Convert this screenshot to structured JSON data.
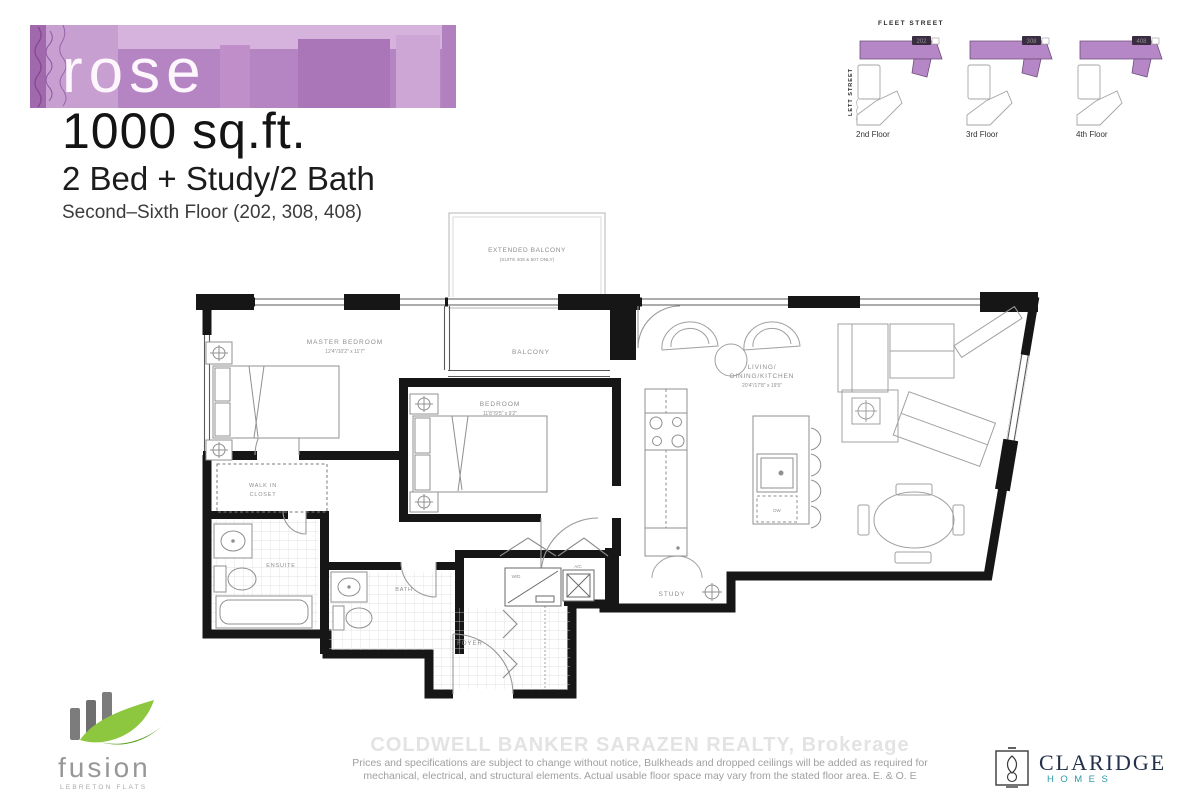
{
  "header": {
    "plan_name": "rose",
    "area": "1000 sq.ft.",
    "configuration": "2 Bed + Study/2 Bath",
    "floors_note": "Second–Sixth Floor (202, 308, 408)"
  },
  "keyplans": {
    "street_top": "FLEET STREET",
    "street_left": "LETT STREET",
    "floors": [
      {
        "label": "2nd Floor",
        "unit": "202"
      },
      {
        "label": "3rd Floor",
        "unit": "308"
      },
      {
        "label": "4th Floor",
        "unit": "408"
      }
    ]
  },
  "floorplan": {
    "extended_balcony": "EXTENDED BALCONY",
    "extended_balcony_note": "(SUITE 408 & 507 ONLY)",
    "balcony": "BALCONY",
    "master_bedroom": "MASTER BEDROOM",
    "master_bedroom_dims": "12'4\"/10'2\" x 11'7\"",
    "bedroom": "BEDROOM",
    "bedroom_dims": "11'8\"/9'5\" x 9'2\"",
    "living_line1": "LIVING/",
    "living_line2": "DINING/KITCHEN",
    "living_dims": "20'4\"/17'8\" x 19'5\"",
    "walk_in_closet_line1": "WALK IN",
    "walk_in_closet_line2": "CLOSET",
    "ensuite": "ENSUITE",
    "bath": "BATH",
    "foyer": "FOYER",
    "study": "STUDY",
    "washer_dryer": "W/D",
    "ac": "A/C",
    "dishwasher": "DW"
  },
  "footer": {
    "watermark": "COLDWELL BANKER SARAZEN REALTY, Brokerage",
    "disclaimer_line1": "Prices and specifications are subject to change without notice, Bulkheads and dropped ceilings will be added as required for",
    "disclaimer_line2": "mechanical, electrical, and structural elements. Actual usable floor space may vary from the stated floor area. E. & O. E",
    "fusion_name": "fusion",
    "fusion_sub": "LEBRETON FLATS",
    "claridge_name": "CLARIDGE",
    "claridge_sub": "HOMES"
  },
  "colors": {
    "banner_purple": "#b584c3",
    "keyplan_purple": "#b687c6",
    "claridge_teal": "#2e9aa6",
    "fusion_green": "#8dc63f"
  }
}
